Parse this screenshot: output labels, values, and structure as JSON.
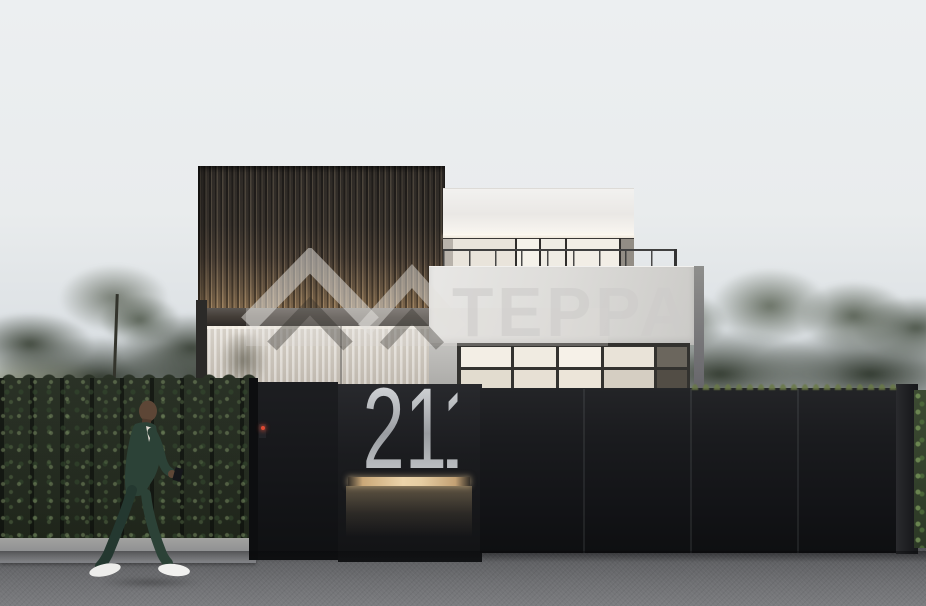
{
  "watermark": {
    "brand": "TEPPA",
    "logo": "double-house-chevron"
  },
  "gate": {
    "house_number": "211"
  },
  "icons": [
    "teppa-logo-icon",
    "intercom-icon"
  ],
  "palette": {
    "sky_top": "#eceff1",
    "sky_horizon": "#c5cbd0",
    "slat_facade": "#35312d",
    "warm_accent_light": "#e6cda2",
    "white_volume": "#dedddA",
    "fence_dark": "#17181a",
    "house_number": "#b6b9bd",
    "road_gray": "#6b6c6f",
    "foliage_green": "#2c3428",
    "suit_green": "#2c4237",
    "sneaker_white": "#efefef",
    "intercom_red": "#e04a33",
    "watermark_gray": "#cdccc9"
  }
}
